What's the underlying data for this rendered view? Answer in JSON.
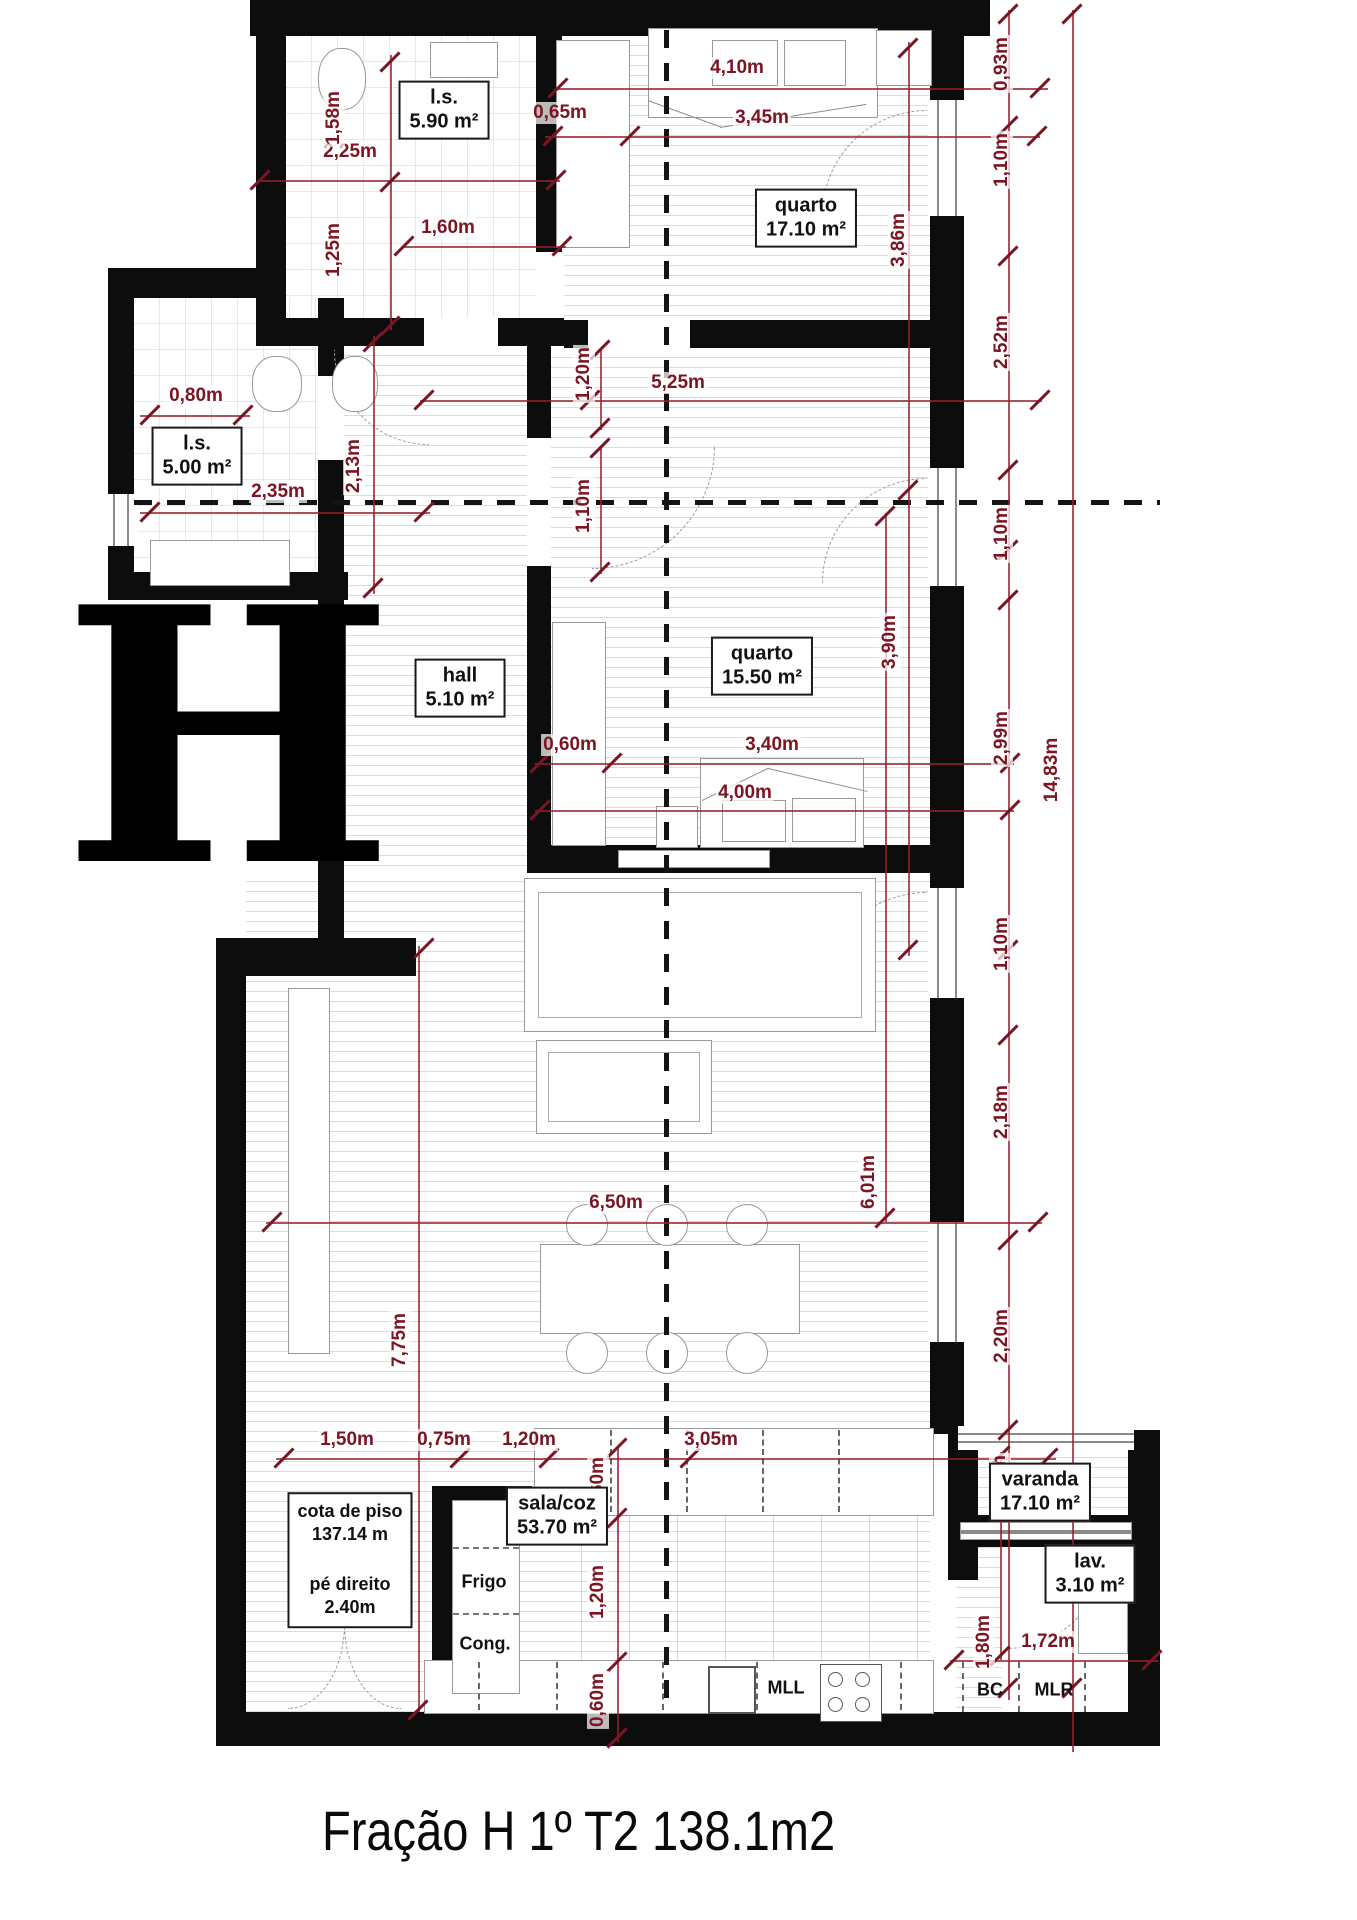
{
  "title": "Fração H 1º T2  138.1m2",
  "fraction_letter": "H",
  "rooms": {
    "ls1": {
      "name": "l.s.",
      "area": "5.90 m²"
    },
    "quarto1": {
      "name": "quarto",
      "area": "17.10 m²"
    },
    "ls2": {
      "name": "l.s.",
      "area": "5.00 m²"
    },
    "hall": {
      "name": "hall",
      "area": "5.10 m²"
    },
    "quarto2": {
      "name": "quarto",
      "area": "15.50 m²"
    },
    "sala": {
      "name": "sala/coz",
      "area": "53.70 m²"
    },
    "varanda": {
      "name": "varanda",
      "area": "17.10 m²"
    },
    "lav": {
      "name": "lav.",
      "area": "3.10 m²"
    }
  },
  "info": {
    "cota_label": "cota de piso",
    "cota_value": "137.14 m",
    "pe_label": "pé direito",
    "pe_value": "2.40m"
  },
  "appliances": {
    "frigo": "Frigo",
    "cong": "Cong.",
    "mll": "MLL",
    "bc": "BC",
    "mlr": "MLR"
  },
  "dimensions": {
    "d225": "2,25m",
    "d065": "0,65m",
    "d160": "1,60m",
    "d410": "4,10m",
    "d345": "3,45m",
    "d525": "5,25m",
    "d235": "2,35m",
    "d080": "0,80m",
    "d060a": "0,60m",
    "d340": "3,40m",
    "d400": "4,00m",
    "d650": "6,50m",
    "d150": "1,50m",
    "d075": "0,75m",
    "d120r": "1,20m",
    "d305": "3,05m",
    "d172": "1,72m",
    "v158": "1,58m",
    "v125": "1,25m",
    "v093": "0,93m",
    "v110a": "1,10m",
    "v252": "2,52m",
    "v386": "3,86m",
    "v213": "2,13m",
    "v120h": "1,20m",
    "v110h": "1,10m",
    "v390": "3,90m",
    "v110b": "1,10m",
    "v299": "2,99m",
    "v1483": "14,83m",
    "v110c": "1,10m",
    "v218": "2,18m",
    "v601": "6,01m",
    "v775": "7,75m",
    "v220": "2,20m",
    "v070": "0,70m",
    "v060b": "0,60m",
    "v120k": "1,20m",
    "v060c": "0,60m",
    "v180": "1,80m"
  },
  "colors": {
    "dimension_red": "#7c1522",
    "wall_black": "#0d0d0d"
  }
}
